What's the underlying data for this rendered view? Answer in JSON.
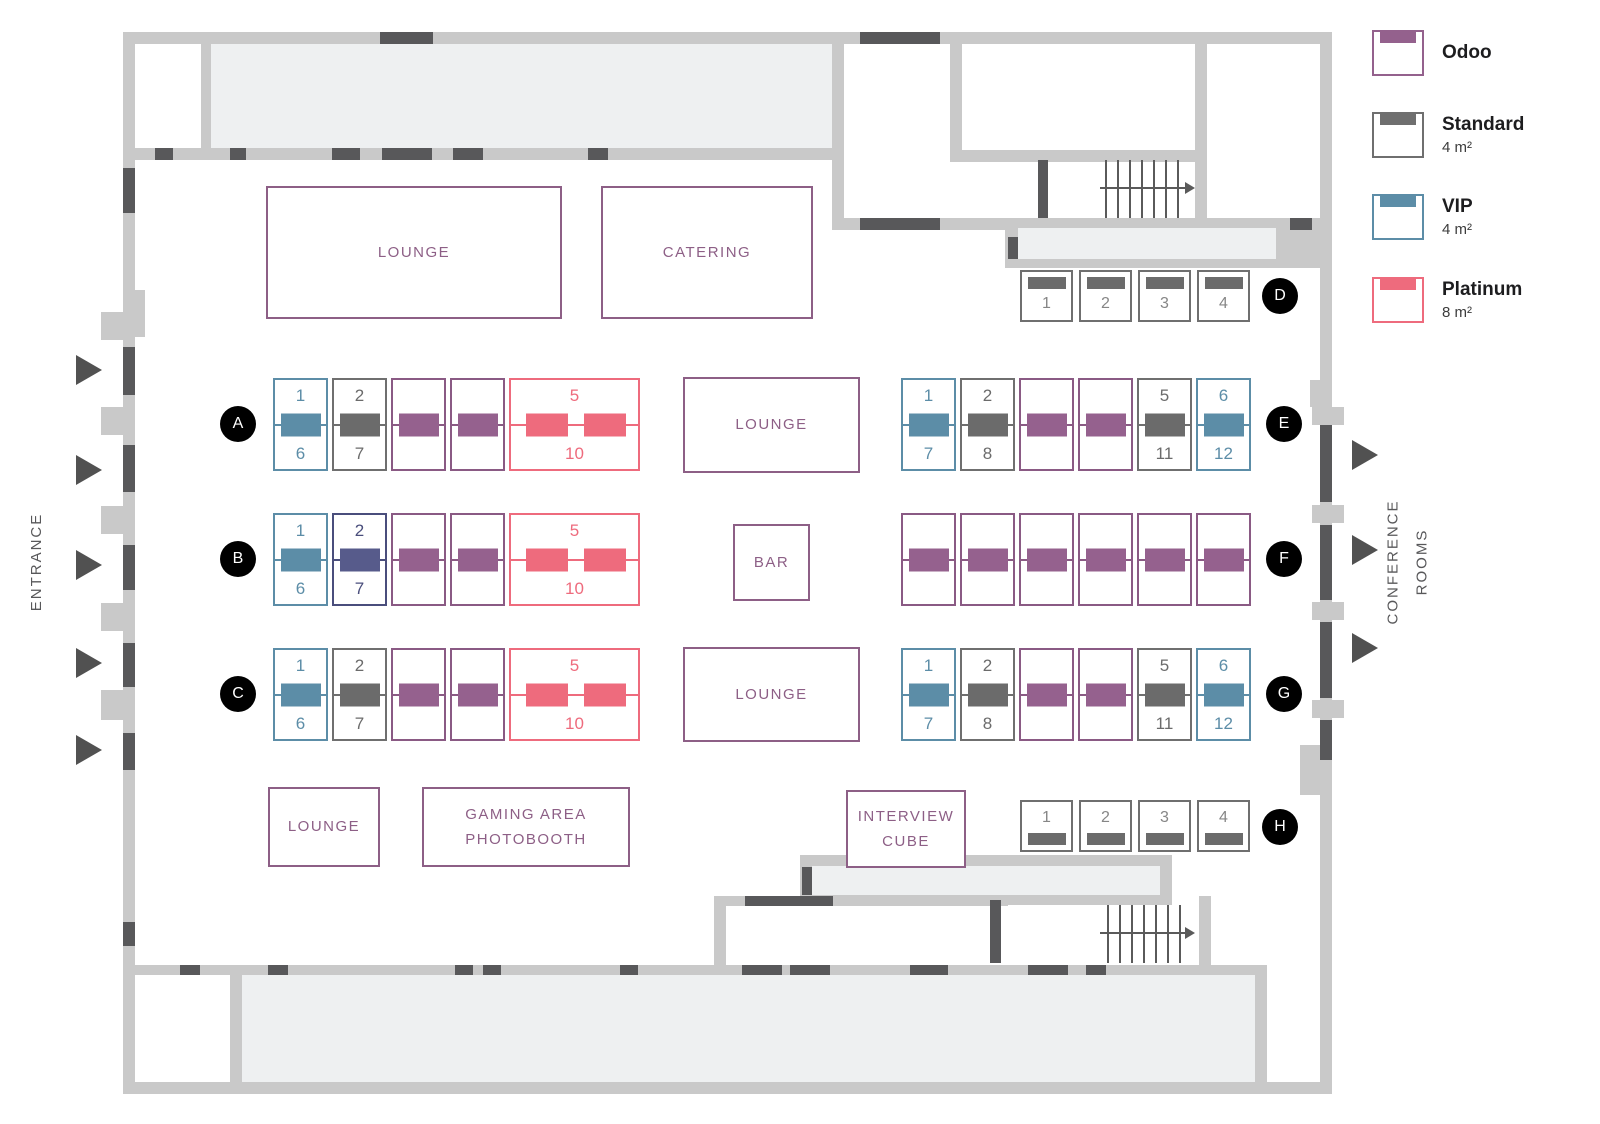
{
  "colors": {
    "wall": "#c9c9c9",
    "room": "#eef0f1",
    "door": "#58585a",
    "purple": "#8d5f86",
    "booth_types": {
      "odoo": {
        "border": "#8a5a84",
        "fill": "#95618e",
        "num": "#8a5a84"
      },
      "standard": {
        "border": "#6f6f6f",
        "fill": "#6b6b6b",
        "num": "#6b6b6b"
      },
      "vip": {
        "border": "#5c8da7",
        "fill": "#5c8da7",
        "num": "#5c8da7"
      },
      "platinum": {
        "border": "#ee6b7d",
        "fill": "#ee6b7d",
        "num": "#ee6b7d"
      },
      "reserved": {
        "border": "#4a4e7c",
        "fill": "#575b8b",
        "num": "#4a4e7c"
      },
      "small": {
        "border": "#6f6f6f",
        "fill": "#6b6b6b",
        "num": "#868686"
      }
    }
  },
  "legend": {
    "items": [
      {
        "label": "Odoo",
        "size": "",
        "color": "#94618d"
      },
      {
        "label": "Standard",
        "size": "4 m²",
        "color": "#6f6f6f"
      },
      {
        "label": "VIP",
        "size": "4 m²",
        "color": "#5c8da7"
      },
      {
        "label": "Platinum",
        "size": "8 m²",
        "color": "#ee6b7d"
      }
    ]
  },
  "labels": {
    "entrance": "ENTRANCE",
    "conference_line1": "CONFERENCE",
    "conference_line2": "ROOMS"
  },
  "areas": {
    "lounge_top": "LOUNGE",
    "catering": "CATERING",
    "lounge_mid_upper": "LOUNGE",
    "bar": "BAR",
    "lounge_mid_lower": "LOUNGE",
    "lounge_bottom": "LOUNGE",
    "gaming_line1": "GAMING AREA",
    "gaming_line2": "PHOTOBOOTH",
    "interview_line1": "INTERVIEW",
    "interview_line2": "CUBE"
  },
  "rows": {
    "A": {
      "label": "A",
      "booths": [
        {
          "type": "vip",
          "top": "1",
          "bottom": "6"
        },
        {
          "type": "standard",
          "top": "2",
          "bottom": "7"
        },
        {
          "type": "odoo"
        },
        {
          "type": "odoo"
        },
        {
          "type": "platinum",
          "top": "5",
          "bottom": "10"
        }
      ]
    },
    "B": {
      "label": "B",
      "booths": [
        {
          "type": "vip",
          "top": "1",
          "bottom": "6"
        },
        {
          "type": "reserved",
          "top": "2",
          "bottom": "7"
        },
        {
          "type": "odoo"
        },
        {
          "type": "odoo"
        },
        {
          "type": "platinum",
          "top": "5",
          "bottom": "10"
        }
      ]
    },
    "C": {
      "label": "C",
      "booths": [
        {
          "type": "vip",
          "top": "1",
          "bottom": "6"
        },
        {
          "type": "standard",
          "top": "2",
          "bottom": "7"
        },
        {
          "type": "odoo"
        },
        {
          "type": "odoo"
        },
        {
          "type": "platinum",
          "top": "5",
          "bottom": "10"
        }
      ]
    },
    "D": {
      "label": "D",
      "bar": "top",
      "booths": [
        {
          "n": "1"
        },
        {
          "n": "2"
        },
        {
          "n": "3"
        },
        {
          "n": "4"
        }
      ]
    },
    "E": {
      "label": "E",
      "booths": [
        {
          "type": "vip",
          "top": "1",
          "bottom": "7"
        },
        {
          "type": "standard",
          "top": "2",
          "bottom": "8"
        },
        {
          "type": "odoo"
        },
        {
          "type": "odoo"
        },
        {
          "type": "standard",
          "top": "5",
          "bottom": "11"
        },
        {
          "type": "vip",
          "top": "6",
          "bottom": "12"
        }
      ]
    },
    "F": {
      "label": "F",
      "booths": [
        {
          "type": "odoo"
        },
        {
          "type": "odoo"
        },
        {
          "type": "odoo"
        },
        {
          "type": "odoo"
        },
        {
          "type": "odoo"
        },
        {
          "type": "odoo"
        }
      ]
    },
    "G": {
      "label": "G",
      "booths": [
        {
          "type": "vip",
          "top": "1",
          "bottom": "7"
        },
        {
          "type": "standard",
          "top": "2",
          "bottom": "8"
        },
        {
          "type": "odoo"
        },
        {
          "type": "odoo"
        },
        {
          "type": "standard",
          "top": "5",
          "bottom": "11"
        },
        {
          "type": "vip",
          "top": "6",
          "bottom": "12"
        }
      ]
    },
    "H": {
      "label": "H",
      "bar": "bottom",
      "booths": [
        {
          "n": "1"
        },
        {
          "n": "2"
        },
        {
          "n": "3"
        },
        {
          "n": "4"
        }
      ]
    }
  }
}
